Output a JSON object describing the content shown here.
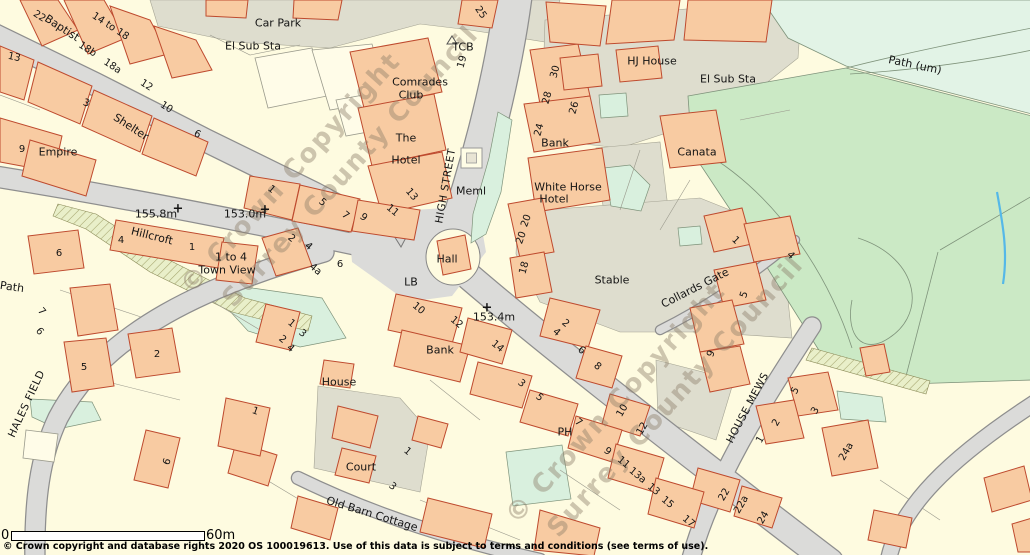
{
  "map": {
    "copyright_line": "© Crown copyright and database rights 2020 OS 100019613.  Use of this data is subject to terms and conditions (see terms of use).",
    "scale_bar": {
      "start_label": "0",
      "end_label": "60m"
    },
    "watermark": {
      "line1": "© Crown Copyright",
      "line2": "Surrey County Council"
    },
    "palette": {
      "building_fill": "#F8CBA2",
      "building_outline": "#BE4A2E",
      "road_fill": "#DBDBD9",
      "road_casing": "#8E8E8E",
      "plot_cream": "#FEFBE0",
      "paved": "#DEDDCE",
      "field_green": "#CBE9C5",
      "mint_green": "#D9F0DE",
      "pale_green": "#E2F3E6",
      "hatch_green": "#E9EFC9",
      "water_blue": "#55B8E8",
      "watermark_color": "#8C7D69"
    },
    "labels": [
      {
        "t": "Car Park",
        "x": 278,
        "y": 23,
        "r": 0,
        "c": "name"
      },
      {
        "t": "El Sub Sta",
        "x": 253,
        "y": 46,
        "r": 0,
        "c": "name"
      },
      {
        "t": "Comrades",
        "x": 420,
        "y": 82,
        "r": 0,
        "c": "name"
      },
      {
        "t": "Club",
        "x": 411,
        "y": 95,
        "r": 0,
        "c": "name"
      },
      {
        "t": "The",
        "x": 406,
        "y": 138,
        "r": 0,
        "c": "name"
      },
      {
        "t": "Hotel",
        "x": 406,
        "y": 160,
        "r": 0,
        "c": "name"
      },
      {
        "t": "TCB",
        "x": 463,
        "y": 47,
        "r": 0,
        "c": "name"
      },
      {
        "t": "HJ House",
        "x": 652,
        "y": 61,
        "r": 0,
        "c": "name"
      },
      {
        "t": "El Sub Sta",
        "x": 728,
        "y": 79,
        "r": 0,
        "c": "name"
      },
      {
        "t": "Bank",
        "x": 555,
        "y": 143,
        "r": 0,
        "c": "name"
      },
      {
        "t": "White Horse",
        "x": 568,
        "y": 187,
        "r": 0,
        "c": "name"
      },
      {
        "t": "Hotel",
        "x": 554,
        "y": 199,
        "r": 0,
        "c": "name"
      },
      {
        "t": "Canata",
        "x": 697,
        "y": 152,
        "r": 0,
        "c": "name"
      },
      {
        "t": "Path (um)",
        "x": 915,
        "y": 65,
        "r": 12,
        "c": "name"
      },
      {
        "t": "Meml",
        "x": 471,
        "y": 191,
        "r": 0,
        "c": "name"
      },
      {
        "t": "Empire",
        "x": 58,
        "y": 152,
        "r": 0,
        "c": "name"
      },
      {
        "t": "Shelter",
        "x": 131,
        "y": 127,
        "r": 33,
        "c": "name"
      },
      {
        "t": "Baptist",
        "x": 62,
        "y": 28,
        "r": 33,
        "c": "name"
      },
      {
        "t": "Hillcroft",
        "x": 152,
        "y": 236,
        "r": 14,
        "c": "name"
      },
      {
        "t": "1 to 4",
        "x": 231,
        "y": 257,
        "r": 0,
        "c": "name"
      },
      {
        "t": "Town View",
        "x": 227,
        "y": 270,
        "r": 0,
        "c": "name"
      },
      {
        "t": "Hall",
        "x": 447,
        "y": 259,
        "r": 0,
        "c": "name"
      },
      {
        "t": "LB",
        "x": 411,
        "y": 282,
        "r": 0,
        "c": "name"
      },
      {
        "t": "Bank",
        "x": 440,
        "y": 350,
        "r": 0,
        "c": "name"
      },
      {
        "t": "House",
        "x": 339,
        "y": 382,
        "r": 0,
        "c": "name"
      },
      {
        "t": "Stable",
        "x": 612,
        "y": 280,
        "r": 0,
        "c": "name"
      },
      {
        "t": "Collards Gate",
        "x": 695,
        "y": 288,
        "r": -27,
        "c": "name"
      },
      {
        "t": "Court",
        "x": 361,
        "y": 467,
        "r": 0,
        "c": "name"
      },
      {
        "t": "Old Barn Cottage",
        "x": 372,
        "y": 514,
        "r": 17,
        "c": "name"
      },
      {
        "t": "PH",
        "x": 565,
        "y": 432,
        "r": 0,
        "c": "name"
      },
      {
        "t": "Path",
        "x": 12,
        "y": 287,
        "r": 8,
        "c": "name"
      },
      {
        "t": "HIGH STREET",
        "x": 446,
        "y": 186,
        "r": -80,
        "c": "street"
      },
      {
        "t": "HALES FIELD",
        "x": 27,
        "y": 404,
        "r": -65,
        "c": "street"
      },
      {
        "t": "HOUSE MEWS",
        "x": 748,
        "y": 408,
        "r": -62,
        "c": "street"
      },
      {
        "t": "155.8m",
        "x": 156,
        "y": 214,
        "r": 0,
        "c": "height"
      },
      {
        "t": "153.0m",
        "x": 245,
        "y": 214,
        "r": 0,
        "c": "height"
      },
      {
        "t": "153.4m",
        "x": 494,
        "y": 317,
        "r": 0,
        "c": "height"
      },
      {
        "t": "+",
        "x": 178,
        "y": 209,
        "r": 0,
        "c": "cross"
      },
      {
        "t": "+",
        "x": 265,
        "y": 210,
        "r": 0,
        "c": "cross"
      },
      {
        "t": "+",
        "x": 487,
        "y": 308,
        "r": 0,
        "c": "cross"
      },
      {
        "t": "22",
        "x": 39,
        "y": 17,
        "r": 33,
        "c": "num"
      },
      {
        "t": "14 to 18",
        "x": 110,
        "y": 27,
        "r": 33,
        "c": "num"
      },
      {
        "t": "18b",
        "x": 87,
        "y": 50,
        "r": 33,
        "c": "num"
      },
      {
        "t": "18a",
        "x": 112,
        "y": 67,
        "r": 33,
        "c": "num"
      },
      {
        "t": "13",
        "x": 14,
        "y": 58,
        "r": 12,
        "c": "num"
      },
      {
        "t": "12",
        "x": 146,
        "y": 86,
        "r": 33,
        "c": "num"
      },
      {
        "t": "3",
        "x": 86,
        "y": 104,
        "r": 20,
        "c": "num"
      },
      {
        "t": "10",
        "x": 166,
        "y": 108,
        "r": 33,
        "c": "num"
      },
      {
        "t": "6",
        "x": 197,
        "y": 135,
        "r": 25,
        "c": "num"
      },
      {
        "t": "9",
        "x": 22,
        "y": 150,
        "r": 0,
        "c": "num"
      },
      {
        "t": "25",
        "x": 480,
        "y": 13,
        "r": 55,
        "c": "num"
      },
      {
        "t": "19",
        "x": 463,
        "y": 62,
        "r": -75,
        "c": "num"
      },
      {
        "t": "30",
        "x": 556,
        "y": 72,
        "r": -75,
        "c": "num"
      },
      {
        "t": "28",
        "x": 548,
        "y": 98,
        "r": -75,
        "c": "num"
      },
      {
        "t": "26",
        "x": 575,
        "y": 108,
        "r": -75,
        "c": "num"
      },
      {
        "t": "24",
        "x": 540,
        "y": 130,
        "r": -75,
        "c": "num"
      },
      {
        "t": "20",
        "x": 527,
        "y": 221,
        "r": -70,
        "c": "num"
      },
      {
        "t": "20",
        "x": 522,
        "y": 238,
        "r": -70,
        "c": "num"
      },
      {
        "t": "18",
        "x": 525,
        "y": 268,
        "r": -75,
        "c": "num"
      },
      {
        "t": "1",
        "x": 271,
        "y": 190,
        "r": 40,
        "c": "num"
      },
      {
        "t": "5",
        "x": 322,
        "y": 203,
        "r": 40,
        "c": "num"
      },
      {
        "t": "7",
        "x": 345,
        "y": 216,
        "r": 40,
        "c": "num"
      },
      {
        "t": "9",
        "x": 363,
        "y": 218,
        "r": 40,
        "c": "num"
      },
      {
        "t": "11",
        "x": 392,
        "y": 211,
        "r": 40,
        "c": "num"
      },
      {
        "t": "13",
        "x": 411,
        "y": 195,
        "r": 50,
        "c": "num"
      },
      {
        "t": "4",
        "x": 121,
        "y": 241,
        "r": 0,
        "c": "num"
      },
      {
        "t": "1",
        "x": 192,
        "y": 248,
        "r": 0,
        "c": "num"
      },
      {
        "t": "2",
        "x": 291,
        "y": 239,
        "r": 40,
        "c": "num"
      },
      {
        "t": "4",
        "x": 308,
        "y": 247,
        "r": 40,
        "c": "num"
      },
      {
        "t": "4a",
        "x": 315,
        "y": 270,
        "r": 40,
        "c": "num"
      },
      {
        "t": "6",
        "x": 340,
        "y": 265,
        "r": 0,
        "c": "num"
      },
      {
        "t": "1",
        "x": 291,
        "y": 324,
        "r": 40,
        "c": "num"
      },
      {
        "t": "3",
        "x": 302,
        "y": 334,
        "r": 40,
        "c": "num"
      },
      {
        "t": "2",
        "x": 282,
        "y": 340,
        "r": 40,
        "c": "num"
      },
      {
        "t": "4",
        "x": 290,
        "y": 349,
        "r": 40,
        "c": "num"
      },
      {
        "t": "10",
        "x": 418,
        "y": 309,
        "r": 40,
        "c": "num"
      },
      {
        "t": "12",
        "x": 456,
        "y": 323,
        "r": 40,
        "c": "num"
      },
      {
        "t": "14",
        "x": 497,
        "y": 347,
        "r": 40,
        "c": "num"
      },
      {
        "t": "2",
        "x": 565,
        "y": 324,
        "r": 40,
        "c": "num"
      },
      {
        "t": "4",
        "x": 556,
        "y": 333,
        "r": 40,
        "c": "num"
      },
      {
        "t": "6",
        "x": 581,
        "y": 351,
        "r": 40,
        "c": "num"
      },
      {
        "t": "8",
        "x": 597,
        "y": 367,
        "r": 40,
        "c": "num"
      },
      {
        "t": "3",
        "x": 521,
        "y": 384,
        "r": 40,
        "c": "num"
      },
      {
        "t": "5",
        "x": 539,
        "y": 398,
        "r": 40,
        "c": "num"
      },
      {
        "t": "1",
        "x": 735,
        "y": 241,
        "r": 45,
        "c": "num"
      },
      {
        "t": "4",
        "x": 790,
        "y": 256,
        "r": 45,
        "c": "num"
      },
      {
        "t": "5",
        "x": 745,
        "y": 295,
        "r": -70,
        "c": "num"
      },
      {
        "t": "9",
        "x": 712,
        "y": 354,
        "r": -70,
        "c": "num"
      },
      {
        "t": "1",
        "x": 407,
        "y": 452,
        "r": 40,
        "c": "num"
      },
      {
        "t": "3",
        "x": 392,
        "y": 487,
        "r": 40,
        "c": "num"
      },
      {
        "t": "7",
        "x": 578,
        "y": 423,
        "r": 40,
        "c": "num"
      },
      {
        "t": "9",
        "x": 607,
        "y": 452,
        "r": 40,
        "c": "num"
      },
      {
        "t": "11",
        "x": 623,
        "y": 463,
        "r": 40,
        "c": "num"
      },
      {
        "t": "13a",
        "x": 637,
        "y": 476,
        "r": 40,
        "c": "num"
      },
      {
        "t": "13",
        "x": 653,
        "y": 490,
        "r": 40,
        "c": "num"
      },
      {
        "t": "15",
        "x": 667,
        "y": 503,
        "r": 40,
        "c": "num"
      },
      {
        "t": "17",
        "x": 688,
        "y": 522,
        "r": 40,
        "c": "num"
      },
      {
        "t": "10",
        "x": 623,
        "y": 411,
        "r": -60,
        "c": "num"
      },
      {
        "t": "12",
        "x": 643,
        "y": 429,
        "r": -60,
        "c": "num"
      },
      {
        "t": "5",
        "x": 796,
        "y": 391,
        "r": -60,
        "c": "num"
      },
      {
        "t": "3",
        "x": 816,
        "y": 411,
        "r": -60,
        "c": "num"
      },
      {
        "t": "2",
        "x": 777,
        "y": 423,
        "r": -60,
        "c": "num"
      },
      {
        "t": "1",
        "x": 761,
        "y": 440,
        "r": -60,
        "c": "num"
      },
      {
        "t": "24a",
        "x": 847,
        "y": 452,
        "r": -60,
        "c": "num"
      },
      {
        "t": "22",
        "x": 725,
        "y": 495,
        "r": -60,
        "c": "num"
      },
      {
        "t": "22a",
        "x": 742,
        "y": 505,
        "r": -60,
        "c": "num"
      },
      {
        "t": "24",
        "x": 764,
        "y": 518,
        "r": -60,
        "c": "num"
      },
      {
        "t": "2",
        "x": 157,
        "y": 355,
        "r": 0,
        "c": "num"
      },
      {
        "t": "5",
        "x": 84,
        "y": 368,
        "r": 0,
        "c": "num"
      },
      {
        "t": "7",
        "x": 41,
        "y": 312,
        "r": 50,
        "c": "num"
      },
      {
        "t": "6",
        "x": 39,
        "y": 332,
        "r": 50,
        "c": "num"
      },
      {
        "t": "6",
        "x": 59,
        "y": 254,
        "r": 0,
        "c": "num"
      },
      {
        "t": "1",
        "x": 255,
        "y": 412,
        "r": 20,
        "c": "num"
      },
      {
        "t": "6",
        "x": 168,
        "y": 462,
        "r": -70,
        "c": "num"
      }
    ]
  }
}
